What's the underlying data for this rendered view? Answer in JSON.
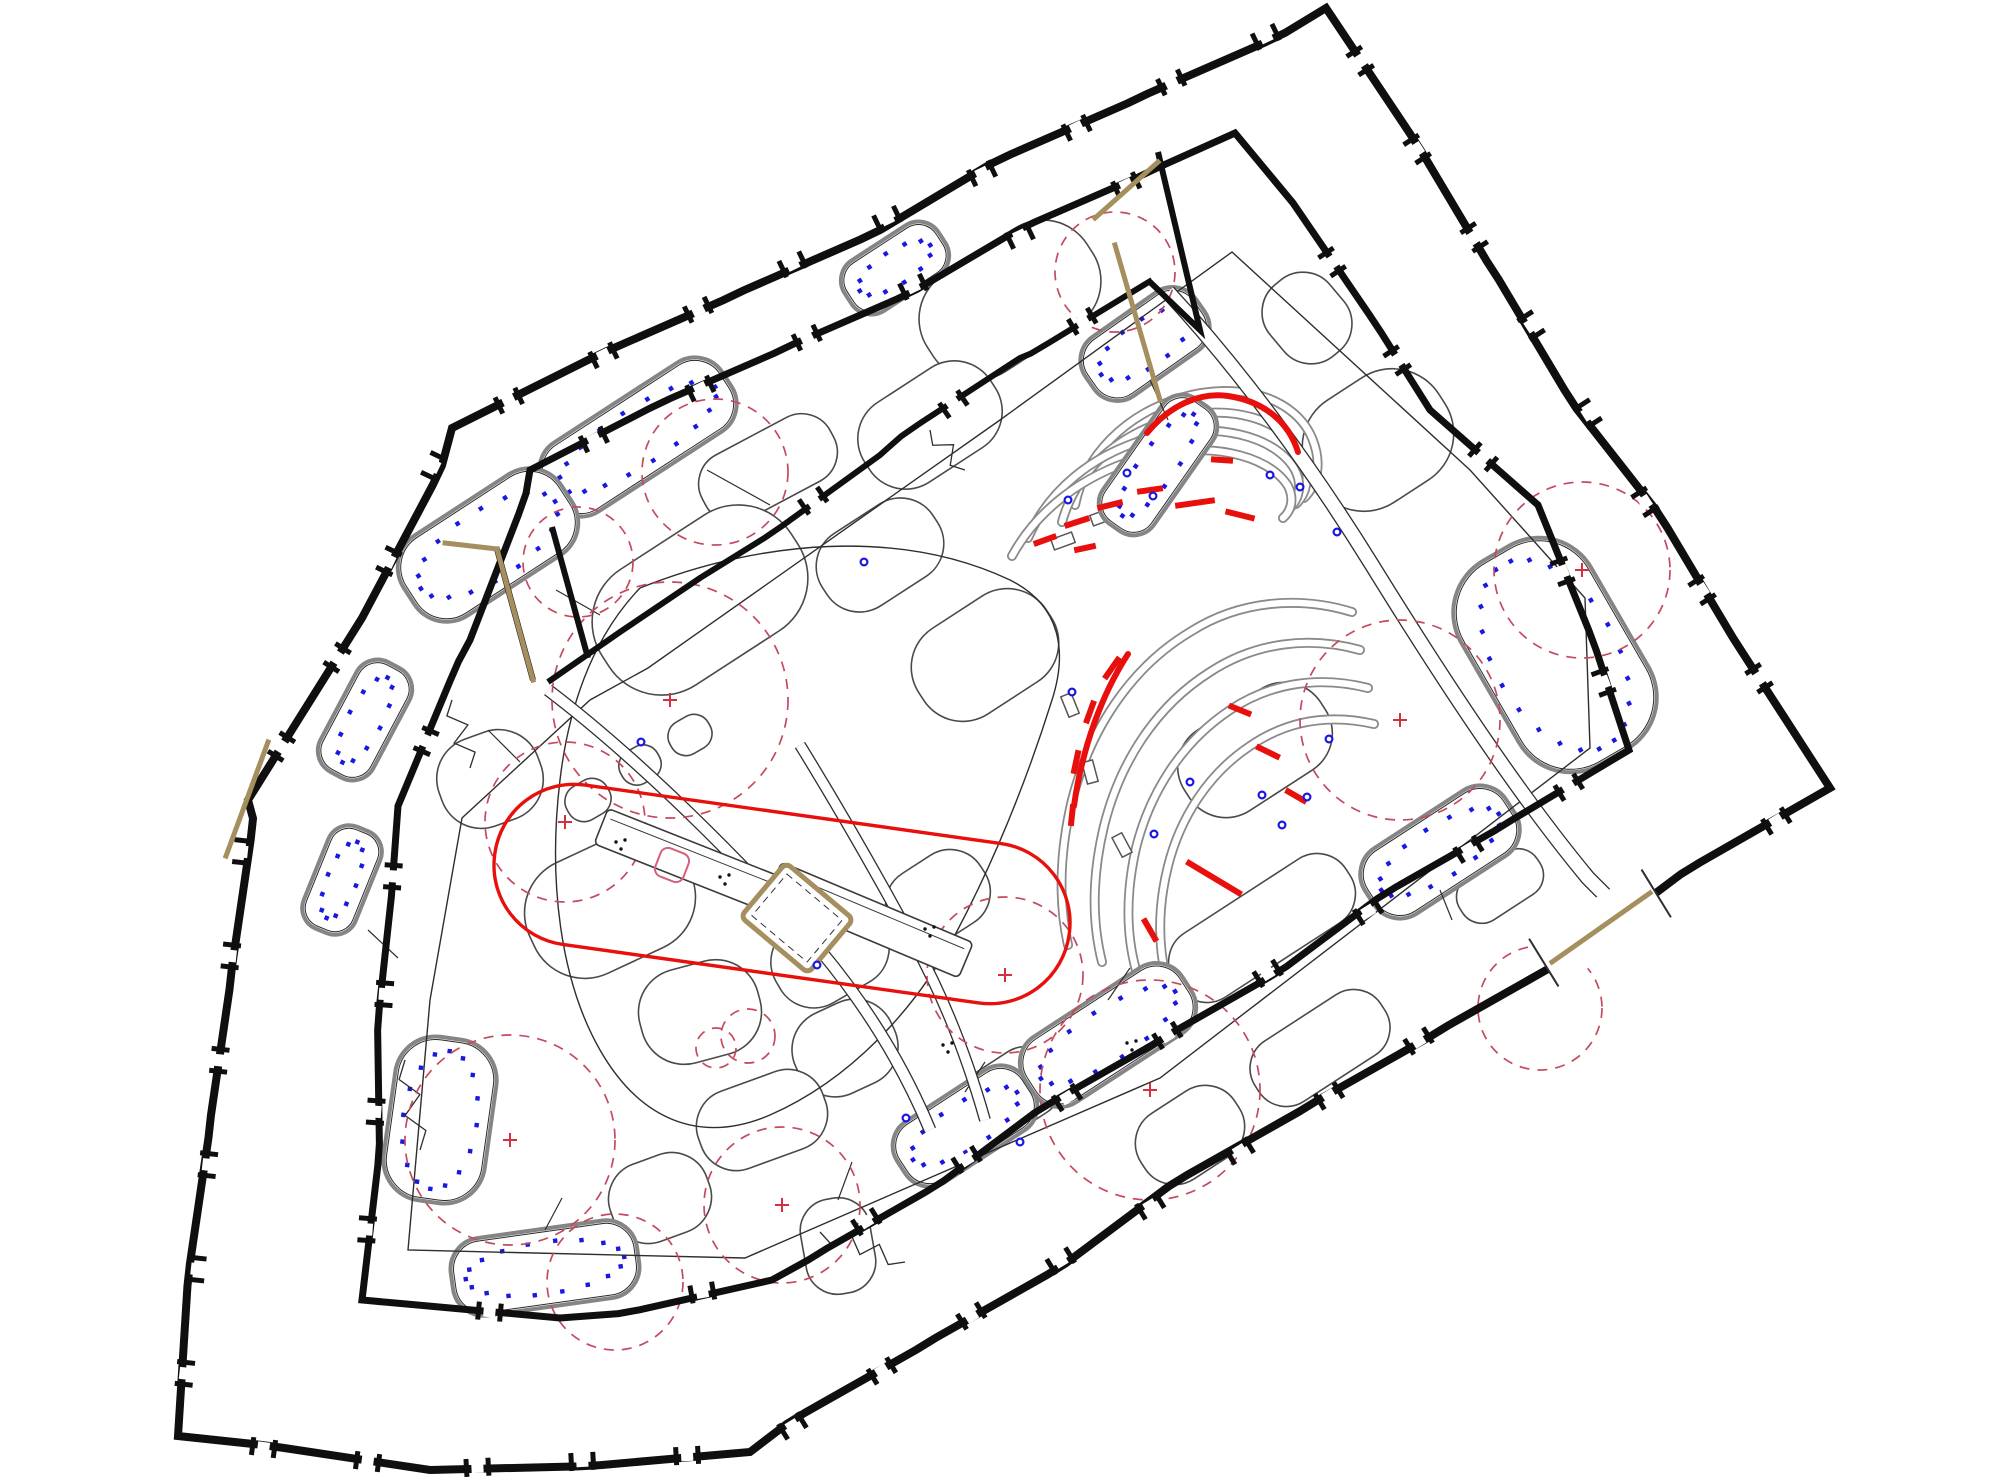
{
  "meta": {
    "drawing_type": "architectural courtyard block site plan",
    "view": "top-down CAD plan, rotated block",
    "visible_text": ""
  },
  "canvas": {
    "width": 2000,
    "height": 1477,
    "background": "#ffffff"
  },
  "palette": {
    "wall": "#0f0f0f",
    "thin_line": "#2e2e2e",
    "band_gray": "#8a8a8a",
    "bed_outline": "#858585",
    "bed_inner": "#2a2a2a",
    "tree_dash": "#c44a5e",
    "red": "#e8100c",
    "tan": "#a68f5e",
    "blue": "#1a17e0",
    "pink": "#d4607a",
    "white": "#ffffff"
  },
  "walls": {
    "outer": [
      [
        1326,
        8
      ],
      [
        1830,
        788
      ],
      [
        750,
        1452
      ],
      [
        430,
        1470
      ],
      [
        178,
        1436
      ],
      [
        248,
        800
      ],
      [
        362,
        618
      ],
      [
        452,
        428
      ]
    ],
    "outer_closed": true,
    "inner_ring": [
      [
        1293,
        203
      ],
      [
        1430,
        410
      ],
      [
        1538,
        505
      ],
      [
        1629,
        750
      ],
      [
        772,
        1280
      ],
      [
        560,
        1318
      ],
      [
        362,
        1300
      ],
      [
        398,
        806
      ],
      [
        470,
        640
      ],
      [
        530,
        470
      ],
      [
        1235,
        133
      ]
    ],
    "inner_closed": true,
    "courtyard_n": [
      [
        1152,
        280
      ],
      [
        1020,
        358
      ],
      [
        880,
        455
      ],
      [
        700,
        578
      ],
      [
        620,
        632
      ],
      [
        548,
        682
      ]
    ],
    "g1_west": [
      [
        1158,
        152
      ],
      [
        1200,
        330
      ],
      [
        1150,
        282
      ]
    ],
    "g1_east": [
      [
        1235,
        133
      ],
      [
        1293,
        203
      ]
    ],
    "g2_west": [
      [
        497,
        549
      ],
      [
        533,
        680
      ]
    ],
    "g2_east": [
      [
        552,
        527
      ],
      [
        588,
        658
      ]
    ],
    "stroke_outer": 8,
    "stroke_inner": 7,
    "stroke_minor": 6
  },
  "gateway_se": {
    "cx": 1600,
    "cy": 928,
    "len": 132,
    "w": 56,
    "rot": -31.6
  },
  "tan_lines": [
    [
      1095,
      218,
      1158,
      162
    ],
    [
      1115,
      245,
      1160,
      400
    ],
    [
      497,
      549,
      533,
      680
    ],
    [
      1552,
      962,
      1650,
      893
    ],
    [
      268,
      742,
      226,
      856
    ],
    [
      445,
      543,
      497,
      549
    ]
  ],
  "ring_path": [
    [
      1232,
      252
    ],
    [
      1470,
      470
    ],
    [
      1585,
      598
    ],
    [
      1590,
      748
    ],
    [
      1160,
      1078
    ],
    [
      745,
      1258
    ],
    [
      408,
      1250
    ],
    [
      430,
      1000
    ],
    [
      462,
      818
    ],
    [
      590,
      700
    ],
    [
      648,
      668
    ],
    [
      1000,
      420
    ]
  ],
  "zigzags": [
    {
      "x1": 452,
      "y1": 700,
      "x2": 470,
      "y2": 768,
      "n": 5,
      "amp": 9
    },
    {
      "x1": 405,
      "y1": 1060,
      "x2": 420,
      "y2": 1150,
      "n": 5,
      "amp": 9
    },
    {
      "x1": 820,
      "y1": 1232,
      "x2": 905,
      "y2": 1262,
      "n": 6,
      "amp": 8
    },
    {
      "x1": 930,
      "y1": 430,
      "x2": 965,
      "y2": 470,
      "n": 4,
      "amp": 8
    }
  ],
  "double_paths": [
    {
      "d": "M 1168 292 C 1240 370 1310 465 1372 565 C 1440 675 1515 790 1588 878 L 1640 930",
      "gap": 16
    },
    {
      "d": "M 548 690 C 640 760 740 860 820 950 C 870 1010 905 1070 930 1130",
      "gap": 13
    },
    {
      "d": "M 800 745 C 840 810 880 880 915 945 C 945 1000 968 1060 985 1120",
      "gap": 12
    }
  ],
  "center_loop": "M 640 588 C 760 540 900 528 1010 580 C 1060 605 1068 650 1052 700 C 1030 770 1000 850 955 935 C 915 1010 850 1080 770 1115 C 700 1145 640 1120 600 1050 C 560 980 548 880 560 780 C 568 712 590 640 640 588 Z",
  "connectors": [
    [
      707,
      470,
      770,
      505
    ],
    [
      556,
      590,
      600,
      615
    ],
    [
      1150,
      380,
      1168,
      420
    ],
    [
      488,
      730,
      520,
      762
    ],
    [
      545,
      1230,
      562,
      1198
    ],
    [
      965,
      1092,
      985,
      1062
    ],
    [
      838,
      1200,
      852,
      1162
    ],
    [
      368,
      930,
      398,
      958
    ],
    [
      1108,
      1000,
      1130,
      968
    ],
    [
      1440,
      890,
      1452,
      920
    ]
  ],
  "terrace_top_bands": [
    "M 1075 505 C 1085 455 1125 415 1180 398 C 1240 380 1295 398 1312 438 C 1322 462 1318 484 1304 498",
    "M 1062 522 C 1075 475 1112 438 1168 420 C 1228 402 1284 418 1302 456 C 1310 474 1308 492 1296 504",
    "M 1028 538 C 1048 492 1090 455 1150 438 C 1215 420 1276 436 1295 470 C 1302 484 1300 498 1290 508",
    "M 1012 556 C 1036 512 1080 476 1140 458 C 1205 440 1268 454 1288 486 C 1294 498 1292 510 1283 518"
  ],
  "terrace_low_bands": [
    "M 1352 612 C 1300 596 1240 600 1190 632 C 1130 668 1090 730 1072 800 C 1060 850 1058 900 1068 945",
    "M 1360 650 C 1310 636 1256 642 1210 672 C 1156 706 1120 762 1104 826 C 1092 876 1092 922 1102 962",
    "M 1368 688 C 1320 676 1272 682 1230 710 C 1182 742 1150 792 1136 848 C 1126 892 1126 934 1136 970",
    "M 1374 724 C 1330 714 1288 720 1250 746 C 1208 774 1180 818 1168 866 C 1158 906 1158 944 1166 978"
  ],
  "red_arcs": [
    "M 1147 433 C 1170 405 1200 392 1228 396 C 1262 401 1288 420 1298 452",
    "M 1128 654 C 1102 694 1082 748 1074 806"
  ],
  "red_dashes": [
    [
      1077,
      522,
      26,
      -18
    ],
    [
      1110,
      505,
      26,
      -14
    ],
    [
      1150,
      490,
      26,
      -8
    ],
    [
      1195,
      503,
      40,
      -8
    ],
    [
      1240,
      515,
      30,
      14
    ],
    [
      1045,
      540,
      24,
      -20
    ],
    [
      1085,
      548,
      22,
      -12
    ],
    [
      1222,
      460,
      22,
      4
    ],
    [
      1112,
      668,
      26,
      -55
    ],
    [
      1090,
      712,
      24,
      -70
    ],
    [
      1076,
      762,
      24,
      -78
    ],
    [
      1072,
      815,
      22,
      -84
    ],
    [
      1214,
      878,
      64,
      31
    ],
    [
      1240,
      710,
      24,
      22
    ],
    [
      1268,
      752,
      26,
      26
    ],
    [
      1296,
      796,
      24,
      30
    ],
    [
      1150,
      930,
      26,
      60
    ]
  ],
  "benches": [
    [
      1102,
      517,
      -20
    ],
    [
      1063,
      541,
      -20
    ],
    [
      1153,
      493,
      -8
    ],
    [
      1070,
      705,
      68
    ],
    [
      1090,
      772,
      75
    ],
    [
      1122,
      845,
      62
    ]
  ],
  "play_area": {
    "cx": 782,
    "cy": 894,
    "len": 420,
    "w": 161,
    "rot": 8,
    "rx": 80
  },
  "pergolas": [
    {
      "cx": 722,
      "cy": 874,
      "len": 260,
      "w": 38,
      "rot": 21.6
    },
    {
      "cx": 870,
      "cy": 920,
      "len": 208,
      "w": 38,
      "rot": 22.8
    }
  ],
  "pink_square": {
    "cx": 672,
    "cy": 865,
    "size": 30,
    "rot": 21
  },
  "sandbox": {
    "cx": 797,
    "cy": 918,
    "size": 88,
    "rot": 40
  },
  "dot_clusters": [
    [
      621,
      845
    ],
    [
      725,
      880
    ],
    [
      930,
      932
    ],
    [
      1132,
      1046
    ],
    [
      948,
      1048
    ]
  ],
  "beds": [
    [
      1145,
      344,
      135,
      72,
      -35,
      14
    ],
    [
      895,
      268,
      112,
      60,
      -33,
      12
    ],
    [
      638,
      437,
      212,
      82,
      -33,
      20
    ],
    [
      488,
      545,
      188,
      96,
      -33,
      18
    ],
    [
      365,
      720,
      124,
      60,
      -62,
      12
    ],
    [
      342,
      880,
      110,
      56,
      -68,
      12
    ],
    [
      440,
      1120,
      102,
      165,
      8,
      16
    ],
    [
      545,
      1268,
      188,
      78,
      -8,
      18
    ],
    [
      965,
      1126,
      152,
      72,
      -33,
      14
    ],
    [
      1108,
      1035,
      188,
      78,
      -33,
      16
    ],
    [
      1440,
      852,
      168,
      78,
      -33,
      16
    ],
    [
      1158,
      465,
      152,
      62,
      -55,
      14
    ],
    [
      1555,
      655,
      150,
      235,
      -30,
      22
    ]
  ],
  "blobs": [
    [
      1010,
      300,
      190,
      115,
      -33
    ],
    [
      930,
      425,
      150,
      95,
      -33
    ],
    [
      768,
      468,
      145,
      72,
      -28
    ],
    [
      1307,
      318,
      78,
      92,
      -40
    ],
    [
      1378,
      440,
      152,
      122,
      -33
    ],
    [
      490,
      779,
      105,
      92,
      -20
    ],
    [
      700,
      600,
      225,
      138,
      -33
    ],
    [
      880,
      555,
      132,
      86,
      -33
    ],
    [
      985,
      655,
      152,
      102,
      -33
    ],
    [
      1255,
      750,
      162,
      96,
      -33
    ],
    [
      610,
      905,
      172,
      122,
      -25
    ],
    [
      700,
      1012,
      122,
      96,
      -15
    ],
    [
      830,
      955,
      120,
      86,
      -30
    ],
    [
      938,
      898,
      106,
      80,
      -33
    ],
    [
      845,
      1048,
      105,
      88,
      -25
    ],
    [
      762,
      1120,
      132,
      82,
      -20
    ],
    [
      1012,
      1092,
      102,
      72,
      -33
    ],
    [
      1262,
      928,
      205,
      76,
      -33
    ],
    [
      1320,
      1048,
      150,
      72,
      -33
    ],
    [
      1190,
      1135,
      112,
      78,
      -33
    ],
    [
      660,
      1198,
      102,
      82,
      -20
    ],
    [
      838,
      1246,
      70,
      96,
      -10
    ],
    [
      588,
      800,
      46,
      38,
      -30
    ],
    [
      640,
      765,
      42,
      36,
      -30
    ],
    [
      690,
      735,
      44,
      36,
      -30
    ],
    [
      1500,
      886,
      92,
      50,
      -33
    ]
  ],
  "tree_circles": [
    [
      715,
      472,
      73,
      0
    ],
    [
      578,
      562,
      55,
      0
    ],
    [
      670,
      700,
      118,
      1
    ],
    [
      565,
      822,
      80,
      1
    ],
    [
      510,
      1140,
      105,
      1
    ],
    [
      615,
      1282,
      68,
      0
    ],
    [
      716,
      1048,
      20,
      0
    ],
    [
      748,
      1036,
      27,
      0
    ],
    [
      782,
      1205,
      78,
      1
    ],
    [
      1005,
      975,
      78,
      1
    ],
    [
      1150,
      1090,
      110,
      1
    ],
    [
      1400,
      720,
      100,
      1
    ],
    [
      1582,
      570,
      88,
      1
    ],
    [
      1540,
      1008,
      62,
      0
    ],
    [
      1115,
      272,
      60,
      0
    ]
  ],
  "blue_points": [
    [
      1127,
      473
    ],
    [
      1270,
      475
    ],
    [
      1300,
      487
    ],
    [
      1153,
      496
    ],
    [
      1068,
      500
    ],
    [
      1337,
      532
    ],
    [
      1072,
      692
    ],
    [
      1190,
      782
    ],
    [
      1262,
      795
    ],
    [
      1307,
      797
    ],
    [
      1282,
      825
    ],
    [
      1154,
      834
    ],
    [
      1329,
      739
    ],
    [
      864,
      562
    ],
    [
      817,
      965
    ],
    [
      906,
      1118
    ],
    [
      1020,
      1142
    ],
    [
      641,
      742
    ]
  ],
  "tick_spacing": {
    "outer": 105,
    "inner": 118,
    "minor": 135
  },
  "tick_skip_zones": [
    [
      1196,
      255,
      95
    ],
    [
      516,
      606,
      95
    ],
    [
      1600,
      928,
      110
    ],
    [
      1326,
      8,
      40
    ]
  ]
}
